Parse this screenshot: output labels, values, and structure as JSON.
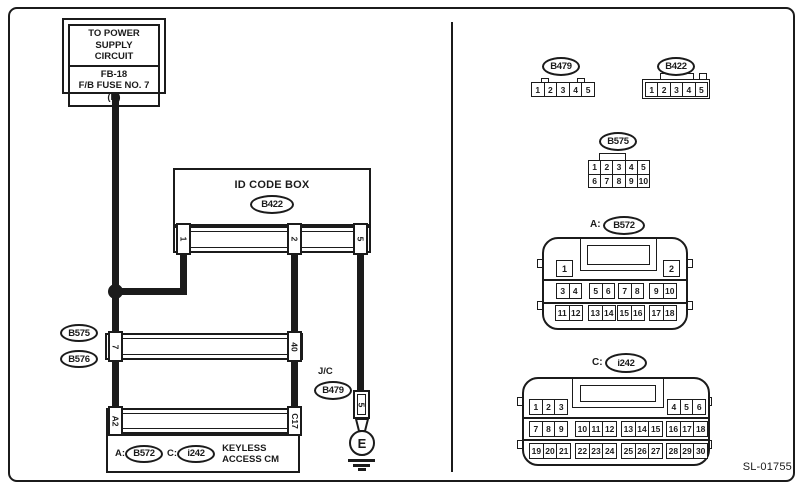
{
  "colors": {
    "line": "#1b1b1b",
    "background": "#ffffff"
  },
  "figure_code": "SL-01755",
  "schematic": {
    "power_box": {
      "lines_top": [
        "TO POWER SUPPLY",
        "CIRCUIT"
      ],
      "lines_bottom": [
        "FB-18",
        "F/B FUSE NO. 7",
        "(B)"
      ]
    },
    "id_code_box": {
      "title": "ID CODE BOX",
      "connector": "B422",
      "pin1": "1",
      "pin2": "2",
      "pin3": "5"
    },
    "inline_connector": {
      "label_top": "B575",
      "label_bottom": "B576",
      "pin_left": "7",
      "pin_right": "40"
    },
    "junction_connector": {
      "type_label": "J/C",
      "label": "B479",
      "pin": "5"
    },
    "ground": {
      "label": "E"
    },
    "keyless_box": {
      "prefix_a": "A:",
      "connector_a": "B572",
      "prefix_c": "C:",
      "connector_c": "i242",
      "name_line1": "KEYLESS",
      "name_line2": "ACCESS CM",
      "pin_a": "A2",
      "pin_c": "C17"
    }
  },
  "connector_views": {
    "b479": {
      "label": "B479",
      "pins": [
        "1",
        "2",
        "3",
        "4",
        "5"
      ]
    },
    "b422": {
      "label": "B422",
      "pins": [
        "1",
        "2",
        "3",
        "4",
        "5"
      ]
    },
    "b575": {
      "label": "B575",
      "row1": [
        "1",
        "2",
        "3",
        "4",
        "5"
      ],
      "row2": [
        "6",
        "7",
        "8",
        "9",
        "10"
      ]
    },
    "b572": {
      "prefix": "A:",
      "label": "B572",
      "pin_left": "1",
      "pin_right": "2",
      "row2": [
        [
          "3",
          "4"
        ],
        [
          "5",
          "6"
        ],
        [
          "7",
          "8"
        ],
        [
          "9",
          "10"
        ]
      ],
      "row3": [
        [
          "11",
          "12"
        ],
        [
          "13",
          "14"
        ],
        [
          "15",
          "16"
        ],
        [
          "17",
          "18"
        ]
      ]
    },
    "i242": {
      "prefix": "C:",
      "label": "i242",
      "row1": [
        [
          "1",
          "2",
          "3"
        ],
        [
          "4",
          "5",
          "6"
        ]
      ],
      "row2": [
        [
          "7",
          "8",
          "9"
        ],
        [
          "10",
          "11",
          "12"
        ],
        [
          "13",
          "14",
          "15"
        ],
        [
          "16",
          "17",
          "18"
        ]
      ],
      "row3": [
        [
          "19",
          "20",
          "21"
        ],
        [
          "22",
          "23",
          "24"
        ],
        [
          "25",
          "26",
          "27"
        ],
        [
          "28",
          "29",
          "30"
        ]
      ]
    }
  }
}
